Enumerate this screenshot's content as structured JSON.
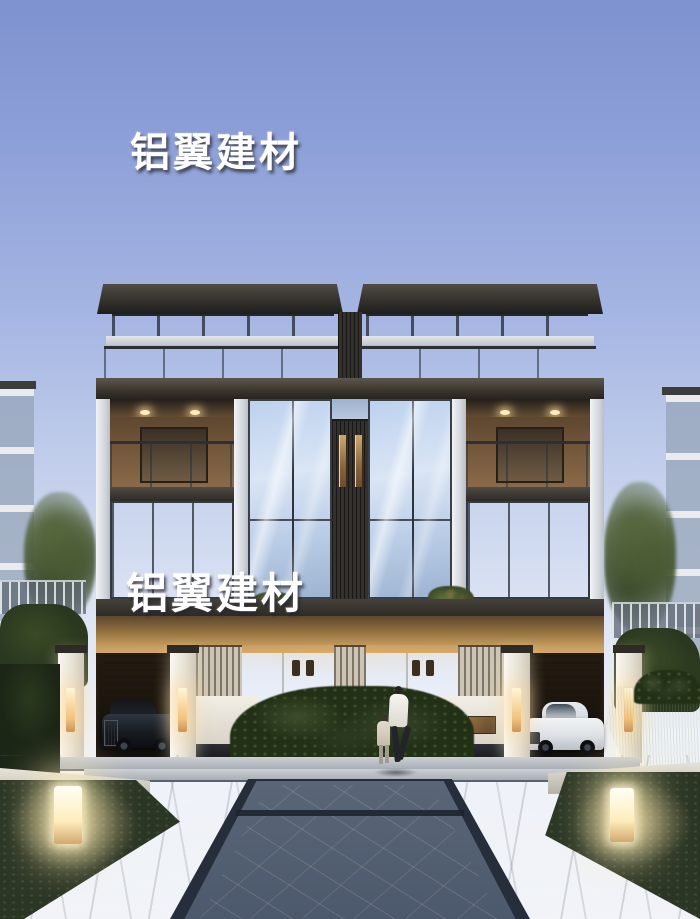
{
  "watermarks": [
    {
      "text": "铝翼建材",
      "color": "#ffffff",
      "position": "upper-sky"
    },
    {
      "text": "铝翼建材",
      "color": "#ffffff",
      "position": "middle-facade"
    }
  ],
  "scene": {
    "description": "Dusk architectural rendering of a symmetric three-story twin villa with glass curtain walls, rooftop glass balustrades, a central louvered core, warm-lit carports holding a black luxury car and a white sedan, white gate piers with glowing lamps, hedges, a stone plaza walkway, a pedestrian with a child, and two glowing bollard lamps",
    "time_of_day": "dusk",
    "elements": [
      "twin-villa",
      "flat-roof-slabs",
      "rooftop-glass-balustrade",
      "clerestory-glass-band",
      "central-louver-core",
      "recessed-balconies-with-downlights",
      "double-height-glass-bays",
      "lit-carport-soffit",
      "black-car",
      "white-car",
      "wood-roller-garage-doors",
      "gate-piers-with-lamps",
      "white-garden-walls",
      "bronze-plaque",
      "center-hedge",
      "side-trees",
      "metal-fences-with-ivy",
      "neighbor-buildings",
      "stone-plaza",
      "dark-slate-walkway",
      "grass-corners",
      "bollard-lamps",
      "pedestrian-with-child"
    ]
  },
  "colors": {
    "sky_top": "#7e92d0",
    "sky_horizon": "#f1f3f8",
    "roof": "#2d2b27",
    "glass": "#bdd2ee",
    "fascia": "#3a352e",
    "warm_wood": "#96744a",
    "lamp_glow": "#ffedbd",
    "white_wall": "#f2eee6",
    "pavement": "#7e8997",
    "walkway_stone": "#4a5971",
    "greenery": "#2c3625",
    "watermark": "#ffffff"
  }
}
